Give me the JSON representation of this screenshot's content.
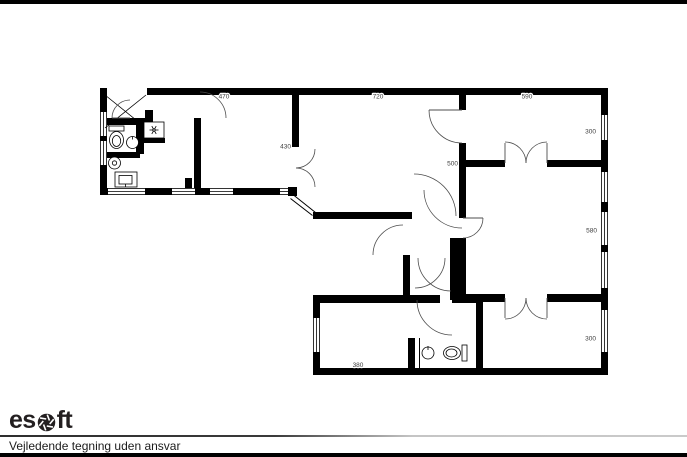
{
  "page": {
    "background": "#ffffff",
    "letterbox_bar_color": "#000000"
  },
  "footer": {
    "logo": {
      "prefix": "es",
      "suffix": "ft",
      "icon": "aperture-icon",
      "color": "#231f20"
    },
    "disclaimer": "Vejledende tegning uden ansvar"
  },
  "plan": {
    "colors": {
      "wall": "#000000",
      "arc": "#4d4d4d",
      "dim_text": "#3c3c3c"
    },
    "dims": {
      "top_left": "470",
      "top_mid": "720",
      "top_right": "590",
      "right_upper": "300",
      "left_mid": "430",
      "mid": "500",
      "right_mid": "580",
      "right_lower": "300",
      "bottom": "380"
    },
    "fixtures": [
      "toilet",
      "sink",
      "extractor-fan",
      "washing-machine",
      "shower",
      "sink",
      "toilet"
    ]
  }
}
